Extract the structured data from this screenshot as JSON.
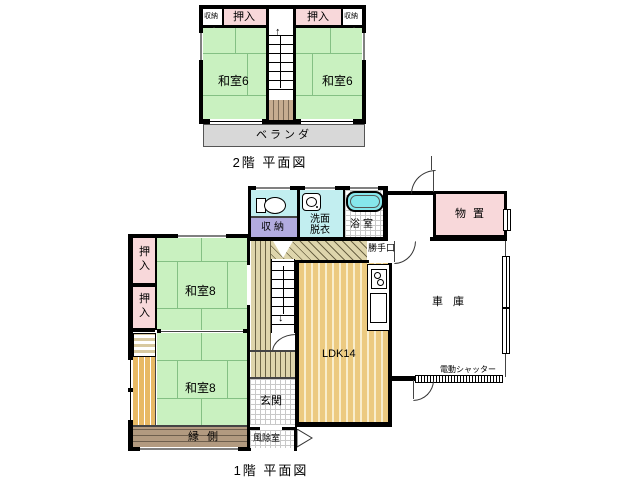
{
  "palette": {
    "tatami_green": "#c9f1c0",
    "closet_pink": "#f8d8da",
    "water_cyan": "#c2eef0",
    "bathtub_cyan": "#86e6ec",
    "storage_purple": "#b2abdf",
    "flooring_orange": "#ecca80",
    "hall_tan": "#ded5ac",
    "engawa_brown": "#b29a80",
    "veranda_gray": "#d8d8d8",
    "wall_black": "#000000"
  },
  "floor2": {
    "title": "2階 平面図",
    "rooms": {
      "closet_left": "収納",
      "oshiire_left": "押入",
      "oshiire_right": "押入",
      "closet_right": "収納",
      "washitsu_left": "和室6",
      "washitsu_right": "和室6",
      "veranda": "ベランダ"
    },
    "stairs_up_icon": "↑"
  },
  "floor1": {
    "title": "1階 平面図",
    "rooms": {
      "storage": "収納",
      "washroom_line1": "洗面",
      "washroom_line2": "脱衣",
      "bath": "浴室",
      "kitchen_door": "勝手口",
      "shed": "物置",
      "oshiire_top": "押入",
      "oshiire_bottom": "押入",
      "washitsu_upper": "和室8",
      "washitsu_lower": "和室8",
      "ldk": "LDK14",
      "garage": "車庫",
      "shutter": "電動シャッター",
      "entrance": "玄関",
      "windbreak": "風除室",
      "engawa": "縁側"
    },
    "stairs_down_icon": "↓"
  }
}
